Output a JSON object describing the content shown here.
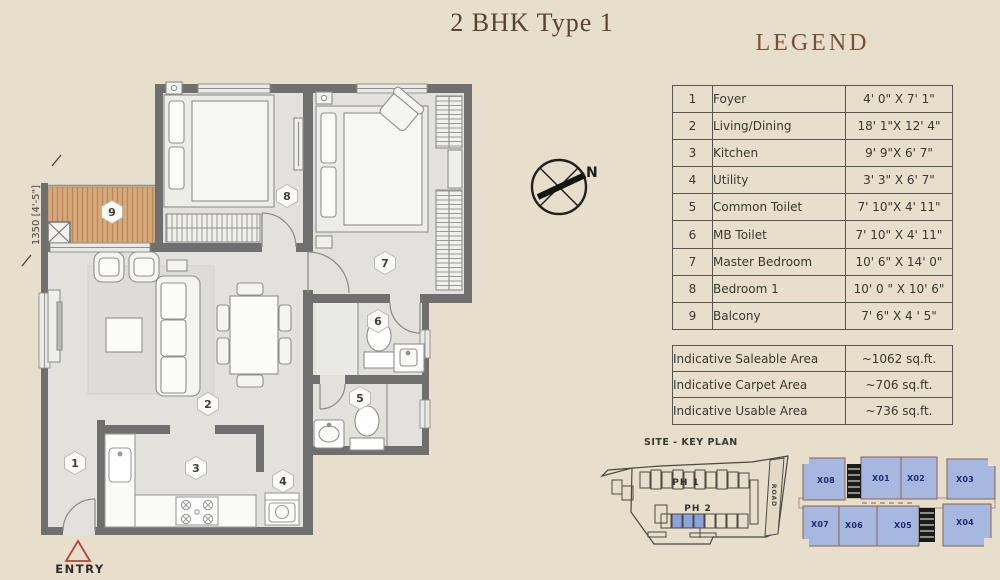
{
  "title": "2 BHK Type 1",
  "colors": {
    "background": "#e7decb",
    "accent_brown": "#7b5038",
    "wall_gray": "#6f6f6f",
    "balcony_wood": "#d7aa7c",
    "entry_red": "#b2453e",
    "keyplan_unit_blue": "#a7b8e0",
    "keyplan_label_navy": "#1d2a6e"
  },
  "legend": {
    "title": "LEGEND",
    "rows": [
      {
        "no": "1",
        "name": "Foyer",
        "size": "4' 0\" X 7' 1\""
      },
      {
        "no": "2",
        "name": "Living/Dining",
        "size": "18' 1\"X 12' 4\""
      },
      {
        "no": "3",
        "name": "Kitchen",
        "size": "9' 9\"X 6' 7\""
      },
      {
        "no": "4",
        "name": "Utility",
        "size": "3' 3\" X 6' 7\""
      },
      {
        "no": "5",
        "name": "Common Toilet",
        "size": "7' 10\"X 4' 11\""
      },
      {
        "no": "6",
        "name": "MB Toilet",
        "size": "7' 10\" X 4' 11\""
      },
      {
        "no": "7",
        "name": "Master Bedroom",
        "size": "10' 6\" X 14' 0\""
      },
      {
        "no": "8",
        "name": "Bedroom 1",
        "size": "10' 0 \" X 10' 6\""
      },
      {
        "no": "9",
        "name": "Balcony",
        "size": "7' 6\" X 4 ' 5\""
      }
    ]
  },
  "areas": {
    "rows": [
      {
        "label": "Indicative Saleable Area",
        "value": "~1062 sq.ft."
      },
      {
        "label": "Indicative Carpet Area",
        "value": "~706 sq.ft."
      },
      {
        "label": "Indicative Usable Area",
        "value": "~736 sq.ft."
      }
    ]
  },
  "floor_plan": {
    "dimension_label": "1350 [4'-5\"]",
    "entry_label": "ENTRY",
    "compass_label": "N",
    "room_numbers": [
      "1",
      "2",
      "3",
      "4",
      "5",
      "6",
      "7",
      "8",
      "9"
    ]
  },
  "site_plan": {
    "title": "SITE - KEY PLAN",
    "ph1": "PH 1",
    "ph2": "PH 2",
    "road": "ROAD"
  },
  "key_plan": {
    "units": [
      "X01",
      "X02",
      "X03",
      "X04",
      "X05",
      "X06",
      "X07",
      "X08"
    ]
  }
}
